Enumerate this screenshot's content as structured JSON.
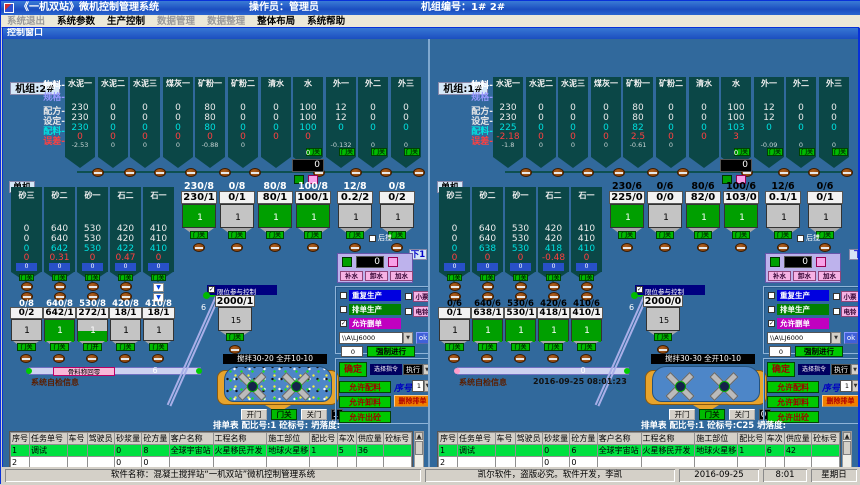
{
  "window": {
    "title": "《一机双站》微机控制管理系统",
    "operator": "操作员：管理员",
    "machine_no": "机组编号：1# 2#"
  },
  "menu": [
    {
      "label": "系统退出",
      "disabled": true
    },
    {
      "label": "系统参数",
      "disabled": false
    },
    {
      "label": "生产控制",
      "disabled": false
    },
    {
      "label": "数据管理",
      "disabled": true
    },
    {
      "label": "数据整理",
      "disabled": true
    },
    {
      "label": "整体布局",
      "disabled": false
    },
    {
      "label": "系统帮助",
      "disabled": false
    }
  ],
  "control_window_title": "控制窗口",
  "status": {
    "software": "软件名称：混凝土搅拌站“一机双站”微机控制管理系统",
    "vendor": "凯尔软件，盗版必究。软件开发，李凯",
    "date": "2016-09-25",
    "time": "8:01",
    "weekday": "星期日"
  },
  "panels": [
    {
      "unit": "机组:2#",
      "single": "单机",
      "tag": "下1",
      "row_labels": [
        "物料",
        "规格",
        "配方",
        "设定",
        "配料",
        "误差"
      ],
      "materials": {
        "names": [
          "水泥一",
          "水泥二",
          "水泥三",
          "煤灰一",
          "矿粉一",
          "矿粉二",
          "清水",
          "水",
          "外一",
          "外二",
          "外三"
        ],
        "recipe": [
          "230",
          "0",
          "0",
          "0",
          "80",
          "0",
          "0",
          "100",
          "12",
          "0",
          "0"
        ],
        "setting": [
          "230",
          "0",
          "0",
          "0",
          "80",
          "0",
          "0",
          "100",
          "12",
          "0",
          "0"
        ],
        "batch": [
          "230",
          "0",
          "0",
          "0",
          "80",
          "0",
          "0",
          "100",
          "0",
          "0",
          "0"
        ],
        "err": [
          "0",
          "0",
          "0",
          "0",
          "0",
          "0",
          "0",
          "0",
          "",
          "",
          ""
        ],
        "err2": [
          "-2.53",
          "0",
          "0",
          "0",
          "-0.88",
          "0",
          "",
          "",
          "-0.132",
          "0",
          "0"
        ]
      },
      "water": {
        "top": "0",
        "display": "0",
        "buttons": [
          "补水",
          "卸水",
          "加水"
        ]
      },
      "rear_mix": "后搅",
      "door_closed": "门关",
      "weighers": {
        "labels": [
          "230/8",
          "0/8",
          "80/8",
          "100/8",
          "12/8",
          "0/8"
        ],
        "values": [
          "230/1",
          "0/1",
          "80/1",
          "100/1",
          "0.2/2",
          "0/2"
        ],
        "count": "1",
        "fills": [
          1,
          0,
          1,
          1,
          0,
          0
        ]
      },
      "aggregates": {
        "names": [
          "砂三",
          "砂二",
          "砂一",
          "石二",
          "石一"
        ],
        "recipe": [
          "0",
          "640",
          "530",
          "420",
          "410"
        ],
        "setting": [
          "0",
          "640",
          "530",
          "420",
          "410"
        ],
        "batch": [
          "0",
          "642",
          "530",
          "422",
          "410"
        ],
        "err": [
          "0",
          "0.31",
          "0",
          "0.47",
          "0"
        ],
        "level": [
          "0",
          "0",
          "0",
          "0",
          "0"
        ],
        "hopper_labels": [
          "0/8",
          "640/8",
          "530/8",
          "420/8",
          "410/8"
        ],
        "hopper_values": [
          "0/2",
          "642/1",
          "272/1",
          "18/1",
          "18/1"
        ],
        "count": "1",
        "fills": [
          0,
          1,
          0.5,
          0,
          0
        ],
        "doors": [
          "门关",
          "门关",
          "门开",
          "门关",
          "门关"
        ]
      },
      "limit_label": "限位参与控制",
      "holding": {
        "value": "2000/1",
        "count": "15"
      },
      "incline_value": "6",
      "belt": {
        "tag": "骨料称回零",
        "value": "6"
      },
      "selfcheck": "系统自检信息",
      "datetime": "",
      "capacity": "容重kg:2422",
      "mixer_label": "搅拌30-20 全开10-10",
      "mixer_doors": {
        "open": "开门",
        "closed": "门关",
        "close": "关门",
        "count": "1"
      },
      "checks": {
        "repeat": "重复生产",
        "queue": "排单生产",
        "allow_delete": "允许删单",
        "ticket": "小票",
        "bell": "电铃"
      },
      "station": {
        "value": "\\\\A\\LJ6000",
        "ok": "ok",
        "force_value": "0",
        "force": "强制进行"
      },
      "commands": {
        "confirm": "确定",
        "mode_label": "选择指令",
        "exec": "执行",
        "allow_batch": "允许配料",
        "seq_label": "序号",
        "seq": "1",
        "allow_discharge": "允许卸料",
        "del": "删除排单",
        "allow_out": "允许出砼"
      },
      "schedule_title": "排单表  配比号:1  砼标号:  坍落度:",
      "table": {
        "headers": [
          "序号",
          "任务单号",
          "车号",
          "驾驶员",
          "砂浆量",
          "砼方量",
          "客户名称",
          "工程名称",
          "施工部位",
          "配比号",
          "车次",
          "供应量",
          "砼标号"
        ],
        "rows": [
          [
            "1",
            "调试",
            "",
            "",
            "0",
            "8",
            "全球宇宙站",
            "火星移民开发",
            "地球火星移",
            "1",
            "5",
            "36",
            ""
          ],
          [
            "2",
            "",
            "",
            "",
            "0",
            "0",
            "",
            "",
            "",
            "",
            "",
            "",
            ""
          ],
          [
            "3",
            "",
            "",
            "",
            "0",
            "0",
            "",
            "",
            "",
            "",
            "",
            "",
            ""
          ],
          [
            "4",
            "",
            "",
            "",
            "0",
            "0",
            "",
            "",
            "",
            "",
            "",
            "",
            ""
          ]
        ]
      }
    },
    {
      "unit": "机组:1#",
      "single": "单机",
      "tag": "下",
      "row_labels": [
        "物料",
        "规格",
        "配方",
        "设定",
        "配料",
        "误差"
      ],
      "materials": {
        "names": [
          "水泥一",
          "水泥二",
          "水泥三",
          "煤灰一",
          "矿粉一",
          "矿粉二",
          "清水",
          "水",
          "外一",
          "外二",
          "外三"
        ],
        "recipe": [
          "230",
          "0",
          "0",
          "0",
          "80",
          "0",
          "0",
          "100",
          "12",
          "0",
          "0"
        ],
        "setting": [
          "230",
          "0",
          "0",
          "0",
          "80",
          "0",
          "0",
          "100",
          "12",
          "0",
          "0"
        ],
        "batch": [
          "225",
          "0",
          "0",
          "0",
          "82",
          "0",
          "0",
          "103",
          "0",
          "0",
          "0"
        ],
        "err": [
          "-2.18",
          "0",
          "0",
          "0",
          "2.5",
          "0",
          "0",
          "3",
          "",
          "",
          ""
        ],
        "err2": [
          "-1.8",
          "0",
          "0",
          "0",
          "-0.61",
          "0",
          "",
          "",
          "-0.09",
          "0",
          "0"
        ]
      },
      "water": {
        "top": "0",
        "display": "0",
        "buttons": [
          "补水",
          "卸水",
          "加水"
        ]
      },
      "rear_mix": "后搅",
      "door_closed": "门关",
      "weighers": {
        "labels": [
          "230/6",
          "0/6",
          "80/6",
          "100/6",
          "12/6",
          "0/6"
        ],
        "values": [
          "225/0",
          "0/0",
          "82/0",
          "103/0",
          "0.1/1",
          "0/1"
        ],
        "count": "1",
        "fills": [
          1,
          0,
          1,
          1,
          0,
          0
        ]
      },
      "aggregates": {
        "names": [
          "砂三",
          "砂二",
          "砂一",
          "石二",
          "石一"
        ],
        "recipe": [
          "0",
          "640",
          "530",
          "420",
          "410"
        ],
        "setting": [
          "0",
          "640",
          "530",
          "420",
          "410"
        ],
        "batch": [
          "0",
          "638",
          "530",
          "418",
          "410"
        ],
        "err": [
          "0",
          "0",
          "0",
          "-0.48",
          "0"
        ],
        "level": [
          "0",
          "0",
          "0",
          "0",
          "0"
        ],
        "hopper_labels": [
          "0/6",
          "640/6",
          "530/6",
          "420/6",
          "410/6"
        ],
        "hopper_values": [
          "0/1",
          "638/1",
          "530/1",
          "418/1",
          "410/1"
        ],
        "count": "1",
        "fills": [
          0,
          1,
          1,
          1,
          1
        ],
        "doors": [
          "门关",
          "门关",
          "门关",
          "门关",
          "门关"
        ]
      },
      "limit_label": "限位参与控制",
      "holding": {
        "value": "2000/0",
        "count": "15"
      },
      "incline_value": "6",
      "belt": {
        "tag": "",
        "value": "0"
      },
      "selfcheck": "系统自检信息",
      "datetime": "2016-09-25  08:01:23",
      "capacity": "容重kg:2422",
      "mixer_label": "搅拌30-30 全开10-10",
      "mixer_doors": {
        "open": "开门",
        "closed": "门关",
        "close": "关门",
        "count": "0"
      },
      "checks": {
        "repeat": "重复生产",
        "queue": "排单生产",
        "allow_delete": "允许删单",
        "ticket": "小票",
        "bell": "电铃"
      },
      "station": {
        "value": "\\\\A\\LJ6000",
        "ok": "ok",
        "force_value": "0",
        "force": "强制进行"
      },
      "commands": {
        "confirm": "确定",
        "mode_label": "选择指令",
        "exec": "执行",
        "allow_batch": "允许配料",
        "seq_label": "序号",
        "seq": "1",
        "allow_discharge": "允许卸料",
        "del": "删除排单",
        "allow_out": "允许出砼"
      },
      "schedule_title": "排单表  配比号:1  砼标号:C25  坍落度:",
      "table": {
        "headers": [
          "序号",
          "任务单号",
          "车号",
          "驾驶员",
          "砂浆量",
          "砼方量",
          "客户名称",
          "工程名称",
          "施工部位",
          "配比号",
          "车次",
          "供应量",
          "砼标号"
        ],
        "rows": [
          [
            "1",
            "调试",
            "",
            "",
            "0",
            "6",
            "全球宇宙站",
            "火星移民开发",
            "地球火星移",
            "1",
            "6",
            "42",
            ""
          ],
          [
            "2",
            "",
            "",
            "",
            "0",
            "0",
            "",
            "",
            "",
            "",
            "",
            "",
            ""
          ],
          [
            "3",
            "",
            "",
            "",
            "0",
            "0",
            "",
            "",
            "",
            "",
            "",
            "",
            ""
          ],
          [
            "4",
            "",
            "",
            "",
            "0",
            "0",
            "",
            "",
            "",
            "",
            "",
            "",
            ""
          ]
        ]
      }
    }
  ],
  "colors": {
    "client_bg": "#31699C",
    "cell_teal": "#0B4747",
    "green": "#00C800",
    "magenta": "#C000C0",
    "blue": "#0000E0",
    "orange": "#F08000"
  }
}
